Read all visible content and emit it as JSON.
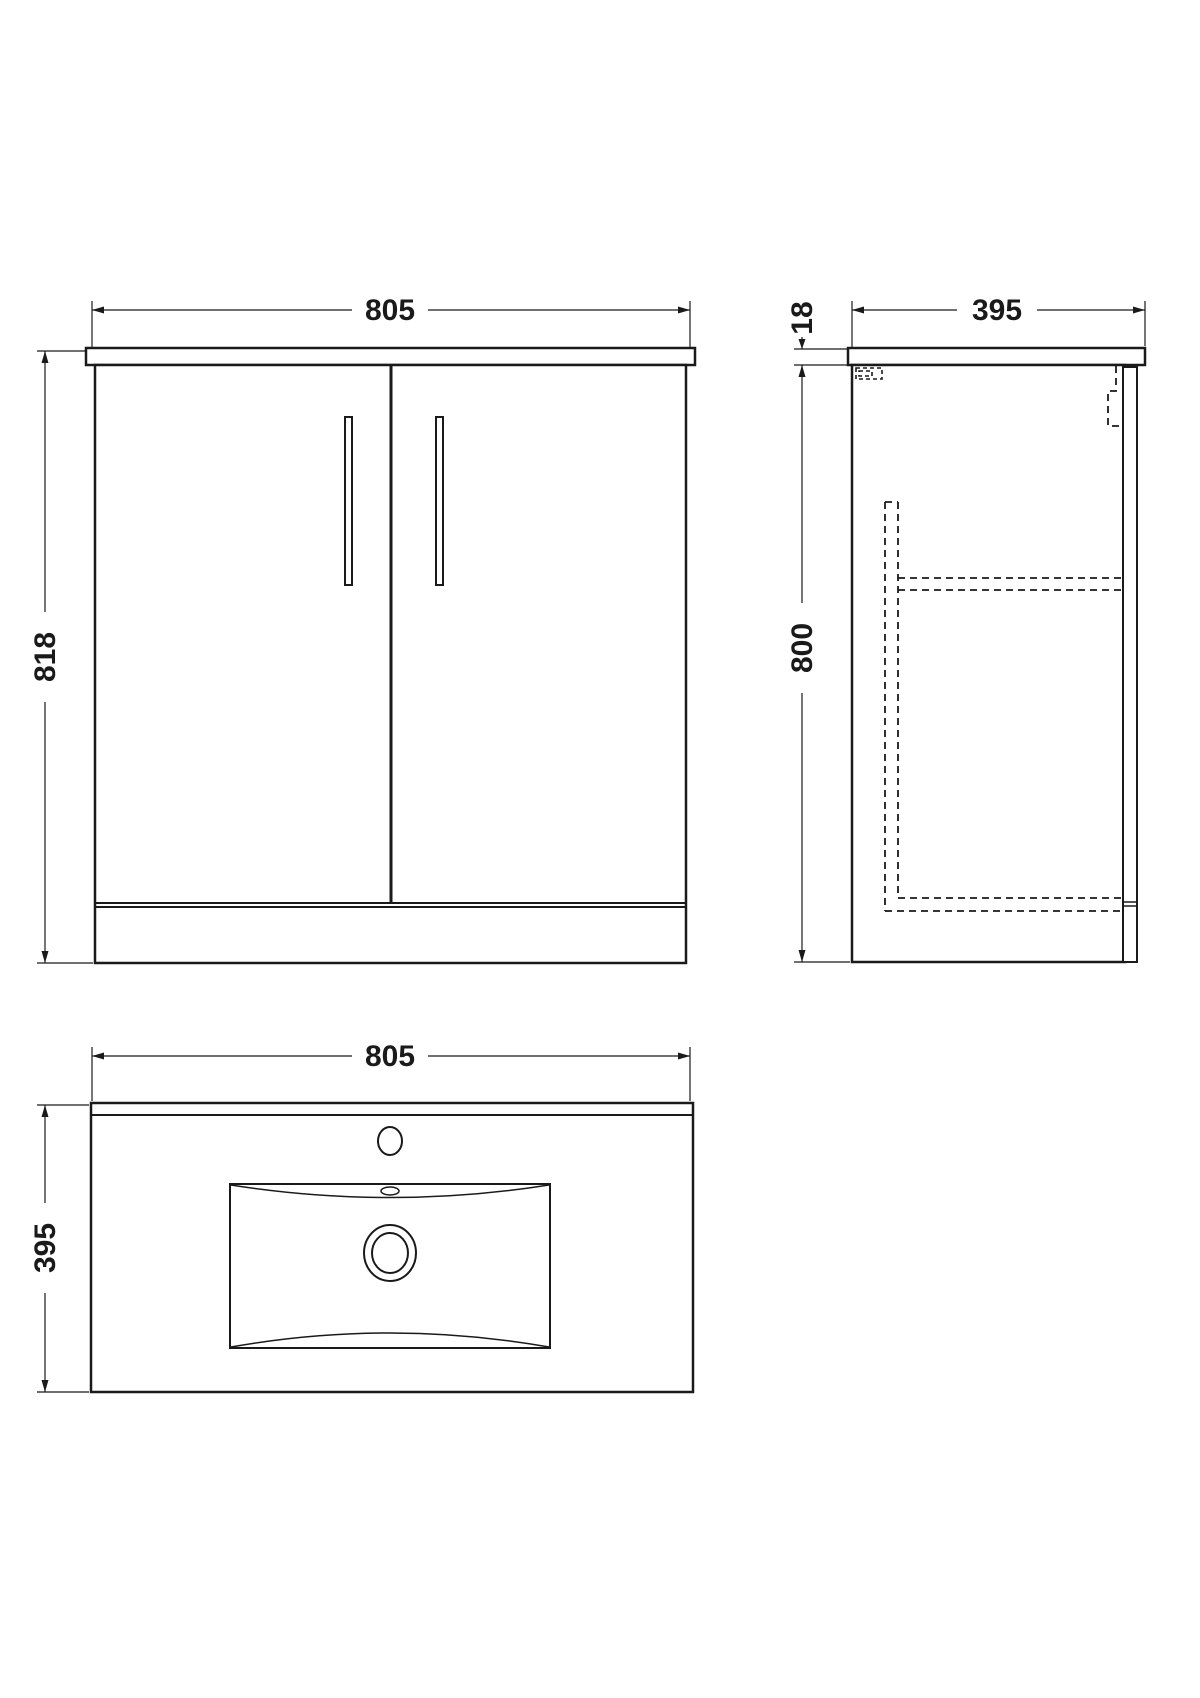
{
  "colors": {
    "line": "#1a1a1a",
    "background": "#ffffff"
  },
  "drawing": {
    "subject": "vanity unit with basin - orthographic technical drawing",
    "views": {
      "front": {
        "width_dim": "805",
        "height_dim": "818"
      },
      "side": {
        "depth_dim": "395",
        "worktop_thickness_dim": "18",
        "carcass_height_dim": "800"
      },
      "plan": {
        "width_dim": "805",
        "depth_dim": "395"
      }
    }
  }
}
